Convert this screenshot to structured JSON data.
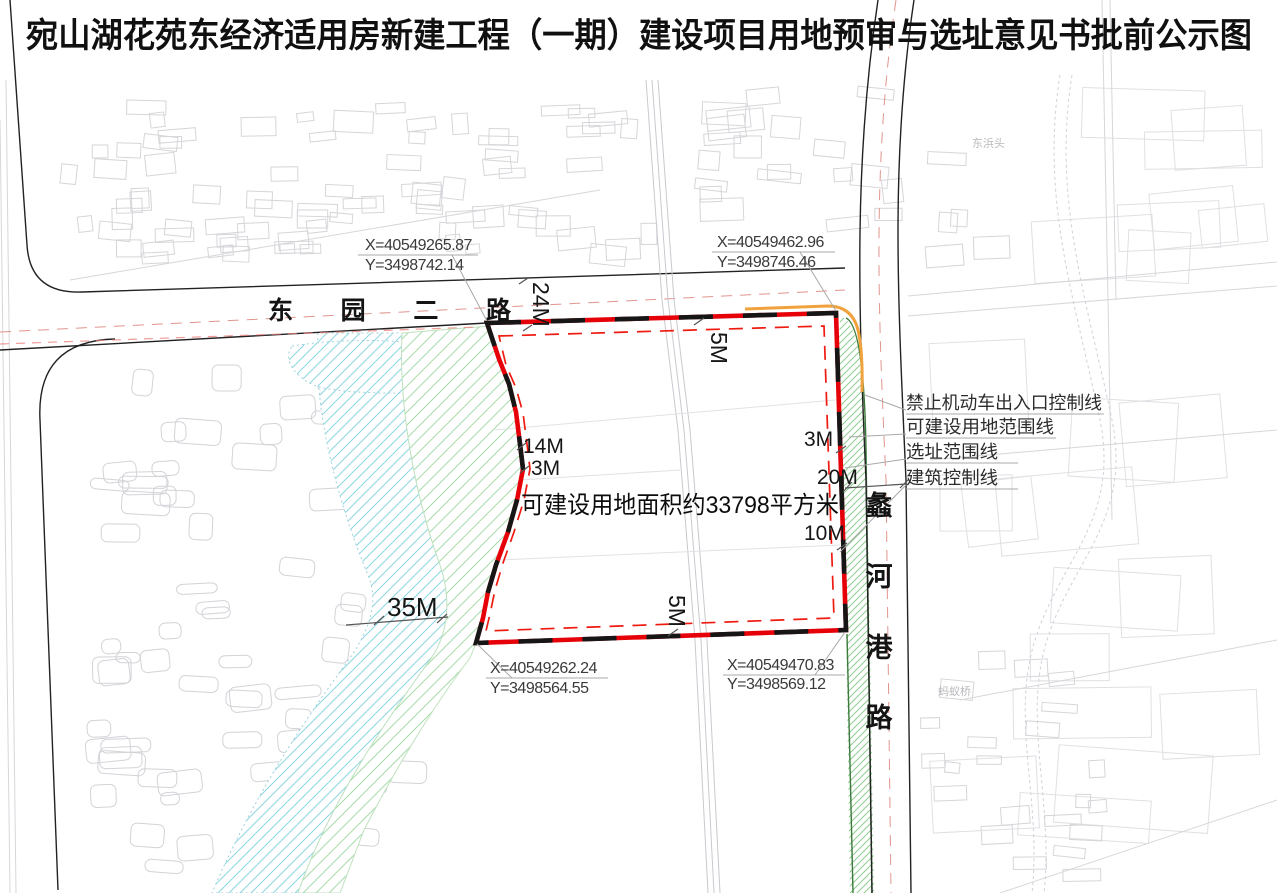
{
  "title": "宛山湖花苑东经济适用房新建工程（一期）建设项目用地预审与选址意见书批前公示图",
  "site": {
    "area_label": "可建设用地面积约33798平方米",
    "boundary_color": "#e60008",
    "building_line_color": "#ef1a10",
    "no_vehicle_line_color": "#f0a23c"
  },
  "roads": {
    "dongyuan_er": {
      "name": "东园二路",
      "label": "东园二路"
    },
    "lihegang": {
      "name": "蠡河港路",
      "chars": [
        "蠡",
        "河",
        "港",
        "路"
      ]
    }
  },
  "corner_coordinates": {
    "top_left": {
      "x": "X=40549265.87",
      "y": "Y=3498742.14"
    },
    "top_right": {
      "x": "X=40549462.96",
      "y": "Y=3498746.46"
    },
    "bottom_left": {
      "x": "X=40549262.24",
      "y": "Y=3498564.55"
    },
    "bottom_right": {
      "x": "X=40549470.83",
      "y": "Y=3498569.12"
    }
  },
  "legend": {
    "items": [
      {
        "label": "禁止机动车出入口控制线",
        "color": "#f0a23c"
      },
      {
        "label": "可建设用地范围线",
        "color": "#e60008"
      },
      {
        "label": "选址范围线",
        "color": "#e60008"
      },
      {
        "label": "建筑控制线",
        "color": "#ef1a10"
      }
    ]
  },
  "dimensions": {
    "dongyuan_road_width": "24M",
    "top_setback": "5M",
    "bottom_setback": "5M",
    "left_setback_a": "14M",
    "left_setback_b": "3M",
    "right_setback_a": "3M",
    "lihegang_road_width": "20M",
    "right_setback_b": "10M",
    "river_corridor_width": "35M"
  },
  "base_map_labels": {
    "village_ne": "东浜头",
    "bridge_se": "蚂蚁桥"
  }
}
